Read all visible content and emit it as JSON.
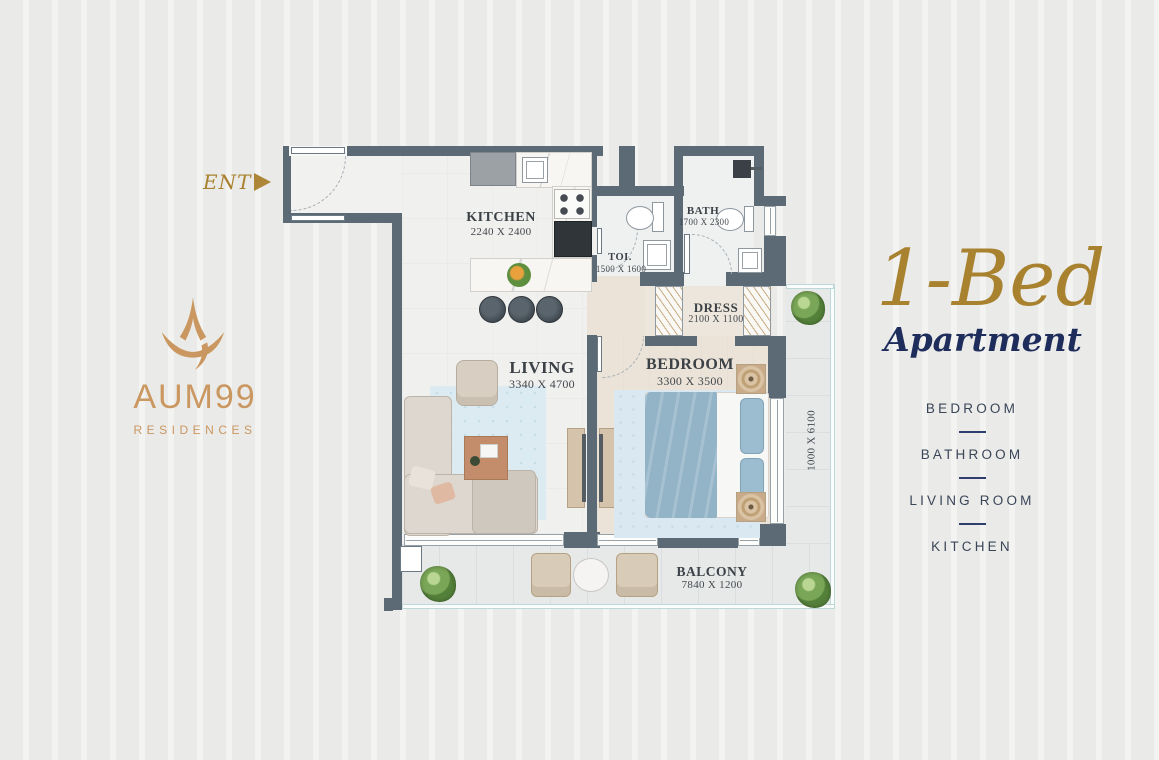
{
  "entry_marker": {
    "label": "ENT"
  },
  "logo": {
    "name": "AUM99",
    "tagline": "RESIDENCES"
  },
  "rooms": {
    "kitchen": {
      "name": "KITCHEN",
      "dim": "2240 X 2400"
    },
    "toilet": {
      "name": "TOI.",
      "dim": "1500 X 1600"
    },
    "bath": {
      "name": "BATH",
      "dim": "1700 X 2300"
    },
    "dress": {
      "name": "DRESS",
      "dim": "2100 X 1100"
    },
    "living": {
      "name": "LIVING",
      "dim": "3340 X 4700"
    },
    "bedroom": {
      "name": "BEDROOM",
      "dim": "3300 X 3500"
    },
    "balcony": {
      "name": "BALCONY",
      "dim": "7840 X 1200"
    },
    "side_balcony": {
      "dim": "1000 X 6100"
    }
  },
  "panel": {
    "title": "1-Bed",
    "subtitle": "Apartment",
    "features": [
      "BEDROOM",
      "BATHROOM",
      "LIVING ROOM",
      "KITCHEN"
    ]
  },
  "colors": {
    "accent_gold": "#a9822f",
    "logo_gold": "#ca9760",
    "navy": "#1e2d5c",
    "wall": "#5c6a75"
  }
}
